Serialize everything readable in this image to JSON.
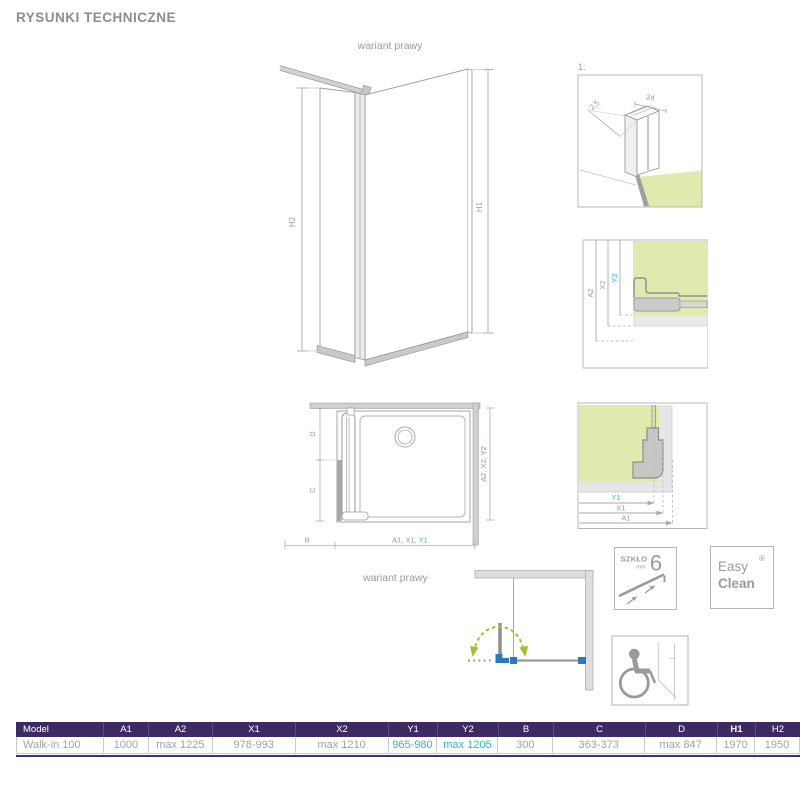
{
  "title": "RYSUNKI TECHNICZNE",
  "captions": {
    "main_variant": "wariant prawy",
    "bottom_variant": "wariant prawy"
  },
  "drawings": {
    "main": {
      "dim_h1": "H1",
      "dim_h2": "H2"
    },
    "detail_profile": {
      "label": "1.",
      "dim_width": "24",
      "dim_depth": "2,5"
    },
    "detail_top": {
      "dim_a2": "A2",
      "dim_x2": "X2",
      "dim_y2": "Y2"
    },
    "plan": {
      "dim_d": "D",
      "dim_c": "C",
      "dim_b": "B",
      "dim_bottom_gray": "A1, X1, ",
      "dim_bottom_cyan": "Y1",
      "dim_right_gray": "A2, X2, ",
      "dim_right_cyan": "Y2"
    },
    "detail_bottom": {
      "dim_y1": "Y1",
      "dim_x1": "X1",
      "dim_a1": "A1"
    }
  },
  "badges": {
    "glass": {
      "brand": "SZKŁO",
      "unit": "mm",
      "value": "6"
    },
    "easyclean": {
      "word1": "Easy",
      "word2": "Clean",
      "reg": "®"
    }
  },
  "icons": {
    "accessibility": "wheelchair-icon",
    "glass_thickness": "glass-pane-icon"
  },
  "colors": {
    "accent_cyan": "#2fb4d4",
    "header_purple": "#3e2a62",
    "drawing_green": "#e0e9ae",
    "arrow_green": "#9cc32f",
    "connector_blue": "#2e78bd",
    "line_gray": "#9e9e9e"
  },
  "table": {
    "headers": [
      "Model",
      "A1",
      "A2",
      "X1",
      "X2",
      "Y1",
      "Y2",
      "B",
      "C",
      "D",
      "H1",
      "H2"
    ],
    "rows": [
      [
        "Walk-in 100",
        "1000",
        "max 1225",
        "978-993",
        "max 1210",
        "965-980",
        "max 1205",
        "300",
        "363-373",
        "max 847",
        "1970",
        "1950"
      ]
    ]
  }
}
